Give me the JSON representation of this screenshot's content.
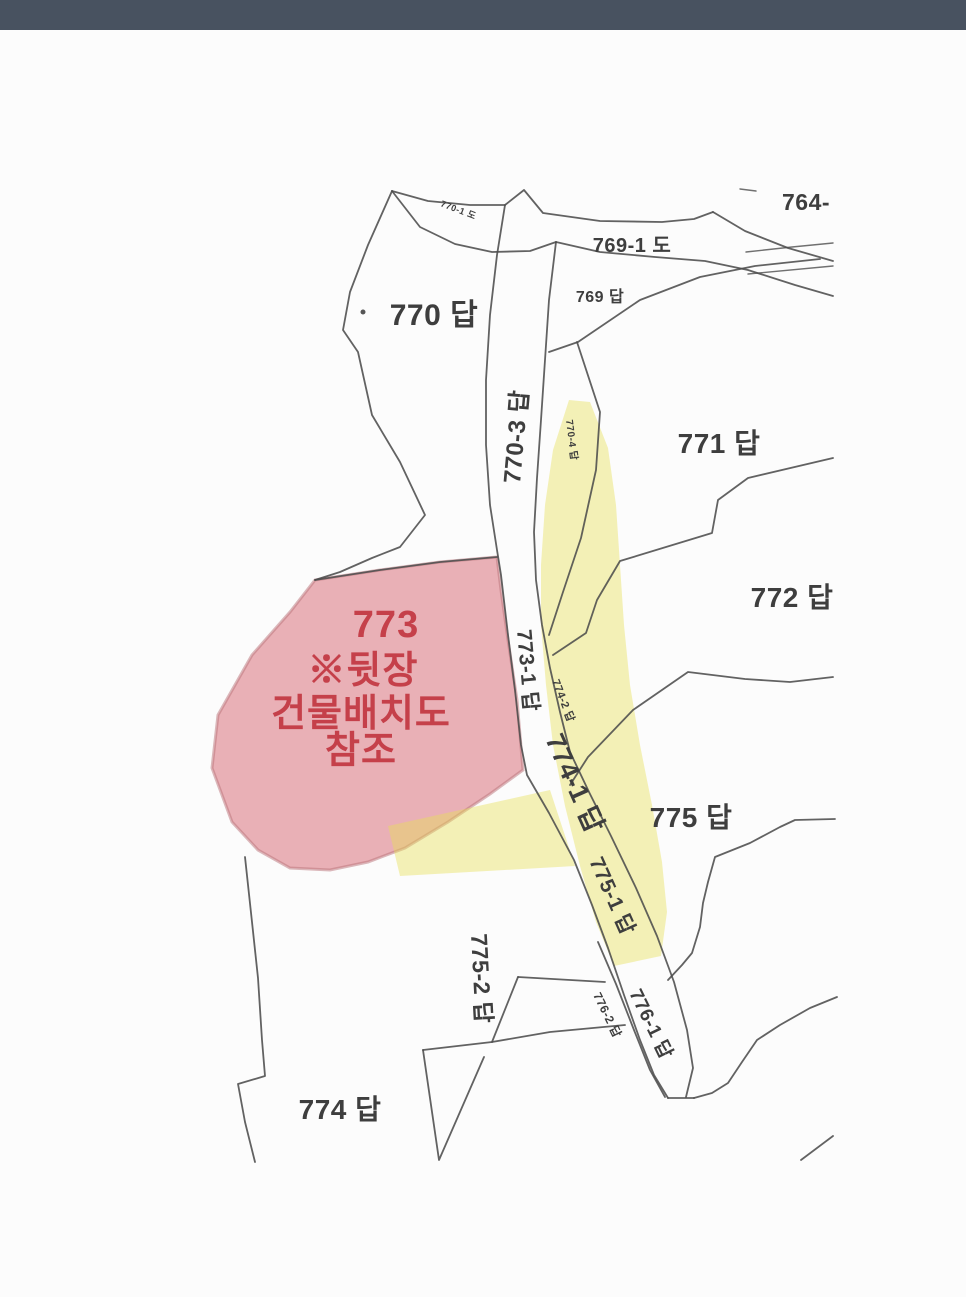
{
  "map": {
    "type": "cadastral-map",
    "colors": {
      "top_bar": "#485260",
      "background": "#fcfcfc",
      "boundary_line": "#4c4c4c",
      "parcel_773_highlight": "#e2949c",
      "road_highlight": "#e8df55",
      "annotation_red": "#c5404a",
      "label_gray": "#3e3e3e"
    },
    "annotation_773": {
      "parcel": "773",
      "note_lines": [
        "773",
        "※뒷장",
        "건물배치도",
        "참조"
      ],
      "meaning": "see building layout drawing on next page"
    },
    "labels": [
      {
        "name": "764",
        "text": "764-",
        "x": 806,
        "y": 210,
        "rot": 0,
        "size": 23,
        "anchor": "middle"
      },
      {
        "name": "769-1",
        "text": "769-1 도",
        "x": 632,
        "y": 252,
        "rot": 0,
        "size": 20,
        "anchor": "middle"
      },
      {
        "name": "769",
        "text": "769 답",
        "x": 600,
        "y": 302,
        "rot": 0,
        "size": 16,
        "anchor": "middle"
      },
      {
        "name": "770",
        "text": "770 답",
        "x": 434,
        "y": 325,
        "rot": 0,
        "size": 30,
        "anchor": "middle"
      },
      {
        "name": "770-1",
        "text": "770-1 도",
        "x": 440,
        "y": 206,
        "rot": 21,
        "size": 9,
        "anchor": "start"
      },
      {
        "name": "770-3",
        "text": "770-3 답",
        "x": 520,
        "y": 484,
        "rot": -85,
        "size": 24,
        "anchor": "start"
      },
      {
        "name": "770-4",
        "text": "770-4 답",
        "x": 566,
        "y": 420,
        "rot": 83,
        "size": 10,
        "anchor": "start"
      },
      {
        "name": "771",
        "text": "771 답",
        "x": 719,
        "y": 453,
        "rot": 0,
        "size": 28,
        "anchor": "middle"
      },
      {
        "name": "772",
        "text": "772 답",
        "x": 792,
        "y": 607,
        "rot": 0,
        "size": 28,
        "anchor": "middle"
      },
      {
        "name": "773-1",
        "text": "773-1 답",
        "x": 517,
        "y": 630,
        "rot": 85,
        "size": 21,
        "anchor": "start"
      },
      {
        "name": "774-2",
        "text": "774-2 답",
        "x": 552,
        "y": 681,
        "rot": 69,
        "size": 11,
        "anchor": "start"
      },
      {
        "name": "774-1",
        "text": "774-1 답",
        "x": 545,
        "y": 739,
        "rot": 66,
        "size": 27,
        "anchor": "start"
      },
      {
        "name": "775",
        "text": "775 답",
        "x": 691,
        "y": 827,
        "rot": 0,
        "size": 28,
        "anchor": "middle"
      },
      {
        "name": "775-1",
        "text": "775-1 답",
        "x": 589,
        "y": 861,
        "rot": 66,
        "size": 21,
        "anchor": "start"
      },
      {
        "name": "775-2",
        "text": "775-2 답",
        "x": 471,
        "y": 934,
        "rot": 87,
        "size": 23,
        "anchor": "start"
      },
      {
        "name": "776-2",
        "text": "776-2 답",
        "x": 593,
        "y": 995,
        "rot": 64,
        "size": 12,
        "anchor": "start"
      },
      {
        "name": "776-1",
        "text": "776-1 답",
        "x": 629,
        "y": 993,
        "rot": 64,
        "size": 19,
        "anchor": "start"
      },
      {
        "name": "774",
        "text": "774 답",
        "x": 340,
        "y": 1119,
        "rot": 0,
        "size": 28,
        "anchor": "middle"
      }
    ],
    "annotation_labels": [
      {
        "name": "773-note-1",
        "text": "773",
        "x": 386,
        "y": 637,
        "size": 38
      },
      {
        "name": "773-note-2",
        "text": "※뒷장",
        "x": 363,
        "y": 683,
        "size": 38
      },
      {
        "name": "773-note-3",
        "text": "건물배치도",
        "x": 361,
        "y": 726,
        "size": 38
      },
      {
        "name": "773-note-4",
        "text": "참조",
        "x": 361,
        "y": 763,
        "size": 38
      }
    ]
  }
}
